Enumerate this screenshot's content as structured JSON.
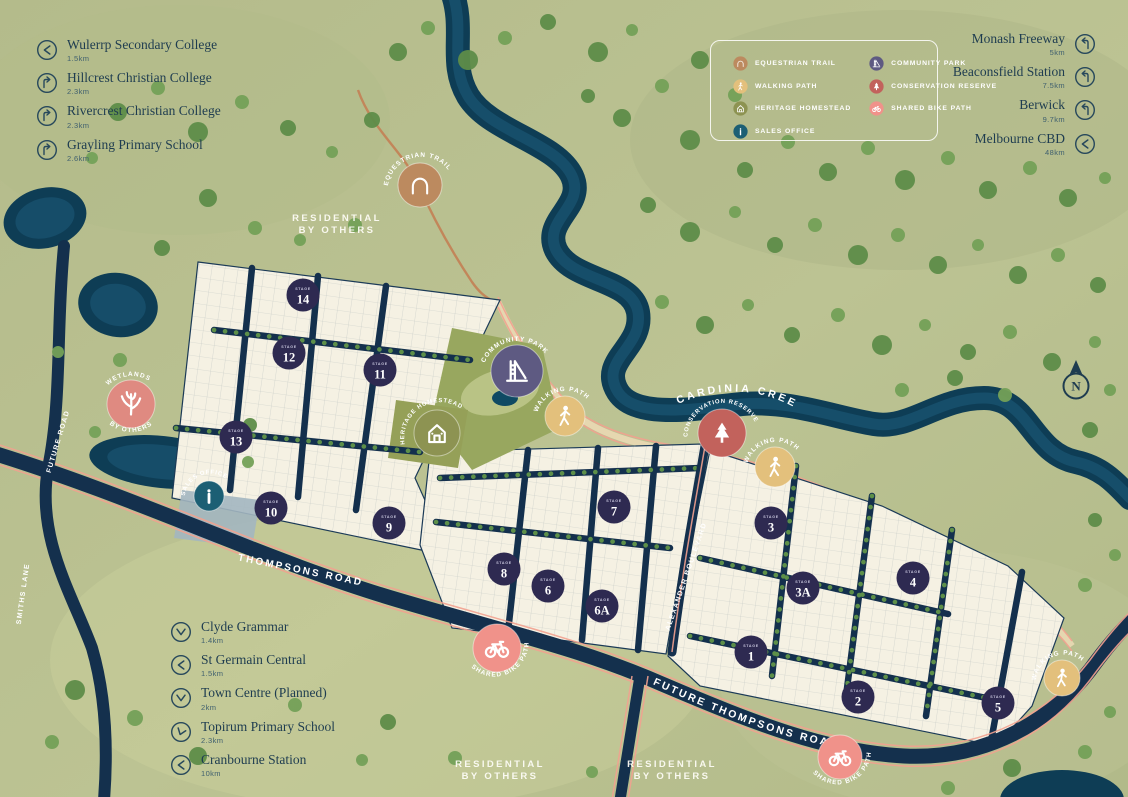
{
  "colors": {
    "background": "#b9c08f",
    "water": "#0e3d55",
    "road": "#14304d",
    "lot_fill": "#f5f1e3",
    "stage_badge": "#2e2a51",
    "equestrian": "#bc8a5f",
    "walking": "#e3c07c",
    "heritage": "#8d9352",
    "sales_office": "#1c5f74",
    "community_park": "#5e5a82",
    "conservation": "#c2625c",
    "shared_bike": "#f0928a",
    "wetlands": "#df8a81",
    "trail_line": "#c2865a",
    "path_pink": "#f2a18f",
    "text": "#1e3c50"
  },
  "legend": {
    "items": [
      {
        "label": "EQUESTRIAN TRAIL",
        "icon": "horseshoe",
        "color": "#bc8a5f"
      },
      {
        "label": "WALKING PATH",
        "icon": "walker",
        "color": "#e3c07c"
      },
      {
        "label": "HERITAGE HOMESTEAD",
        "icon": "homestead",
        "color": "#8d9352"
      },
      {
        "label": "SALES OFFICE",
        "icon": "info",
        "color": "#1c5f74"
      },
      {
        "label": "COMMUNITY PARK",
        "icon": "playground-slide",
        "color": "#5e5a82"
      },
      {
        "label": "CONSERVATION RESERVE",
        "icon": "pine-tree",
        "color": "#c2625c"
      },
      {
        "label": "SHARED BIKE PATH",
        "icon": "bicycle",
        "color": "#f0928a"
      }
    ]
  },
  "landmarks": {
    "top_left": [
      {
        "name": "Wulerrp Secondary College",
        "dist": "1.5km"
      },
      {
        "name": "Hillcrest Christian College",
        "dist": "2.3km"
      },
      {
        "name": "Rivercrest Christian College",
        "dist": "2.3km"
      },
      {
        "name": "Grayling Primary School",
        "dist": "2.6km"
      }
    ],
    "top_right": [
      {
        "name": "Monash Freeway",
        "dist": "5km"
      },
      {
        "name": "Beaconsfield Station",
        "dist": "7.5km"
      },
      {
        "name": "Berwick",
        "dist": "9.7km"
      },
      {
        "name": "Melbourne CBD",
        "dist": "48km"
      }
    ],
    "bottom_left": [
      {
        "name": "Clyde Grammar",
        "dist": "1.4km"
      },
      {
        "name": "St Germain Central",
        "dist": "1.5km"
      },
      {
        "name": "Town Centre (Planned)",
        "dist": "2km"
      },
      {
        "name": "Topirum Primary School",
        "dist": "2.3km"
      },
      {
        "name": "Cranbourne Station",
        "dist": "10km"
      }
    ]
  },
  "map": {
    "stage_word": "STAGE",
    "stages": [
      "14",
      "12",
      "11",
      "13",
      "10",
      "9",
      "7",
      "8",
      "6",
      "6A",
      "3",
      "3A",
      "4",
      "1",
      "2",
      "5"
    ],
    "road_labels": {
      "thompsons": "THOMPSONS ROAD",
      "future_thompsons": "FUTURE THOMPSONS ROAD",
      "alexander": "ALEXANDER BOULEVARD",
      "future_road": "FUTURE ROAD",
      "smiths_lane": "SMITHS LANE",
      "cardinia_creek": "CARDINIA CREEK"
    },
    "area_labels": {
      "residential_line1": "RESIDENTIAL",
      "residential_line2": "BY OTHERS"
    },
    "markers": {
      "equestrian_trail": "EQUESTRIAN TRAIL",
      "wetlands": "WETLANDS",
      "wetlands_sub": "BY OTHERS",
      "community_park": "COMMUNITY PARK",
      "heritage_homestead": "HERITAGE HOMESTEAD",
      "walking_path": "WALKING PATH",
      "conservation_reserve": "CONSERVATION RESERVE",
      "sales_office": "SALES OFFICE",
      "shared_bike_path": "SHARED BIKE PATH"
    },
    "north_label": "N"
  }
}
